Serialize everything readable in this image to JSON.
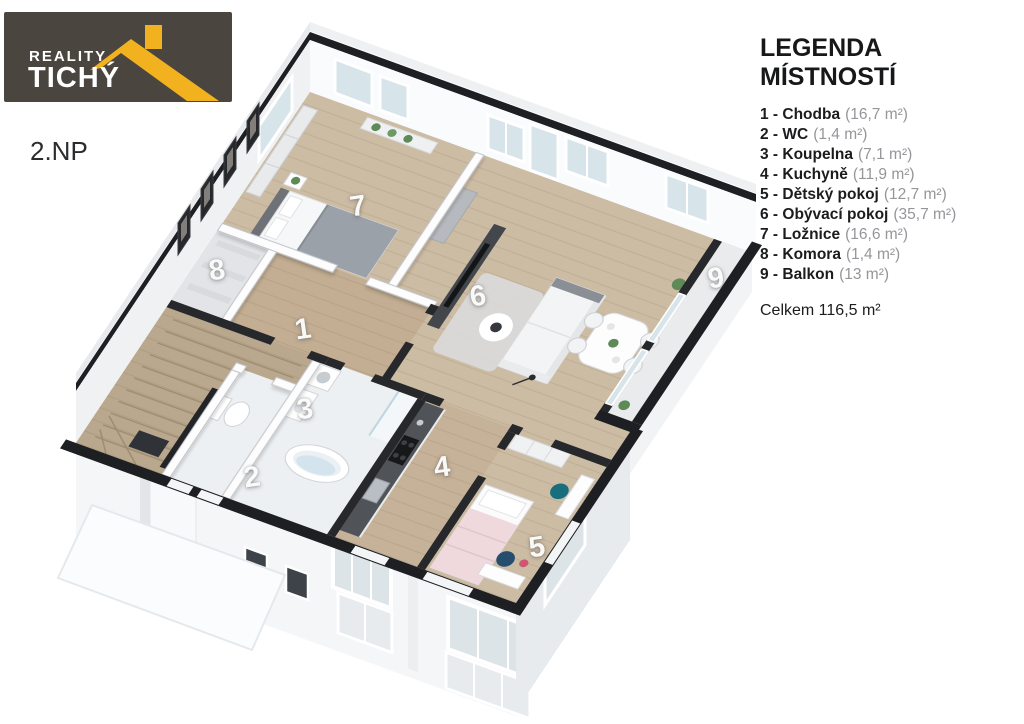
{
  "logo": {
    "line1": "REALITY",
    "line2": "TICHÝ",
    "icon": "roof-icon",
    "bg_color": "#4a453f",
    "accent_color": "#f2b11e"
  },
  "floor_label": "2.NP",
  "legend": {
    "title": "LEGENDA MÍSTNOSTÍ",
    "items": [
      {
        "label": "1 - Chodba",
        "area": "(16,7 m²)"
      },
      {
        "label": "2 - WC",
        "area": "(1,4 m²)"
      },
      {
        "label": "3 - Koupelna",
        "area": "(7,1 m²)"
      },
      {
        "label": "4 - Kuchyně",
        "area": "(11,9 m²)"
      },
      {
        "label": "5 - Dětský pokoj",
        "area": "(12,7 m²)"
      },
      {
        "label": "6 - Obývací pokoj",
        "area": "(35,7 m²)"
      },
      {
        "label": "7 - Ložnice",
        "area": "(16,6 m²)"
      },
      {
        "label": "8 - Komora",
        "area": "(1,4 m²)"
      },
      {
        "label": "9 - Balkon",
        "area": "(13 m²)"
      }
    ],
    "total": "Celkem 116,5 m²"
  },
  "plan": {
    "room_labels": [
      {
        "num": "1",
        "x": 303,
        "y": 330
      },
      {
        "num": "2",
        "x": 252,
        "y": 478
      },
      {
        "num": "3",
        "x": 305,
        "y": 410
      },
      {
        "num": "4",
        "x": 442,
        "y": 468
      },
      {
        "num": "5",
        "x": 537,
        "y": 548
      },
      {
        "num": "6",
        "x": 478,
        "y": 297
      },
      {
        "num": "7",
        "x": 358,
        "y": 207
      },
      {
        "num": "8",
        "x": 217,
        "y": 271
      },
      {
        "num": "9",
        "x": 716,
        "y": 279
      }
    ]
  }
}
